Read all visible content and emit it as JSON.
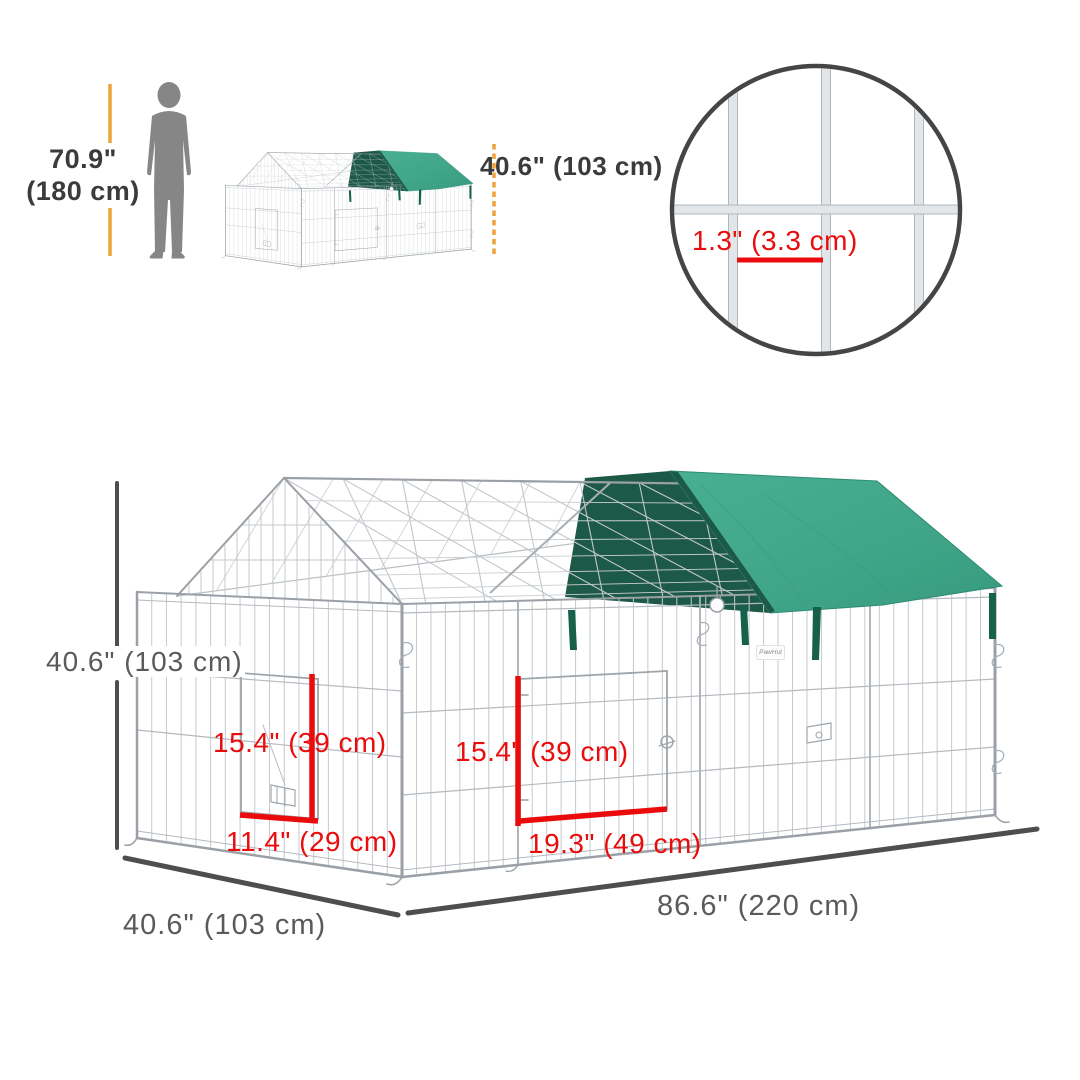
{
  "scale_reference": {
    "person_height_value": "70.9\"",
    "person_height_metric": "(180 cm)",
    "covered_height_label": "40.6\" (103 cm)"
  },
  "mesh_detail": {
    "gap_label": "1.3\" (3.3 cm)"
  },
  "dimensions": {
    "cage_height_label": "40.6\" (103 cm)",
    "left_door_height_label": "15.4\" (39 cm)",
    "left_door_width_label": "11.4\" (29 cm)",
    "front_door_height_label": "15.4\" (39 cm)",
    "front_door_width_label": "19.3\" (49 cm)",
    "depth_label": "40.6\" (103 cm)",
    "length_label": "86.6\" (220 cm)"
  },
  "brand": {
    "logo_text": "PawHut"
  },
  "colors": {
    "accent_red": "#ea0c0c",
    "dimension_amber": "#eca438",
    "dim_line_gray": "#4e4e4e",
    "label_gray": "#5a5a5a",
    "tarp_green": "#42a68a",
    "tarp_shadow_green": "#1d5947",
    "wire_gray": "#c5cacd",
    "silhouette_gray": "#868686"
  }
}
